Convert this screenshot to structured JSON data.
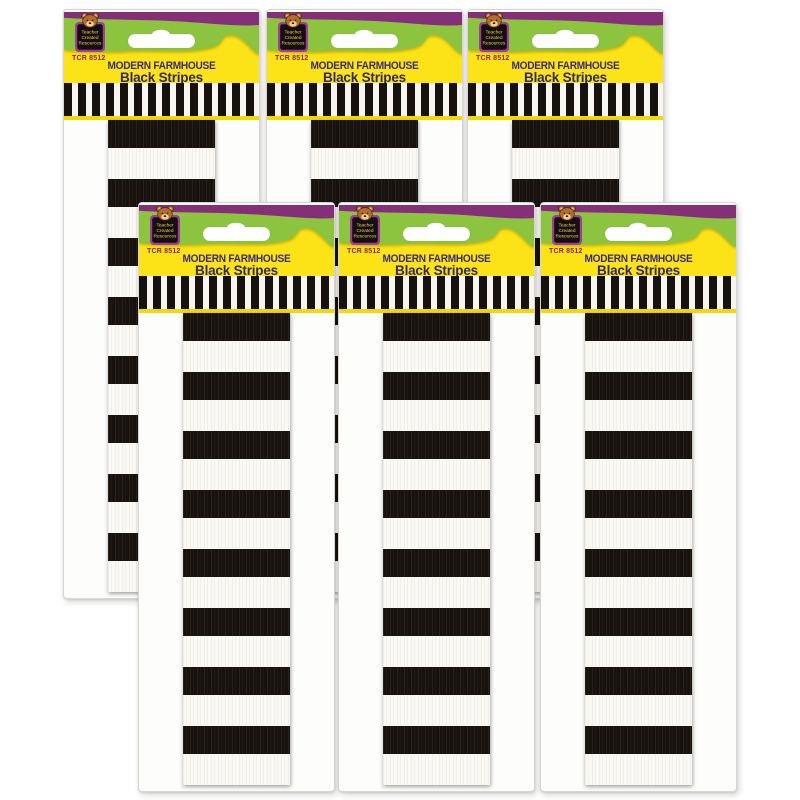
{
  "image_kind": "product-photo",
  "product": {
    "sku": "TCR 8512",
    "title_line1": "MODERN FARMHOUSE",
    "title_line2": "Black Stripes",
    "brand_badge": {
      "line1": "Teacher",
      "line2": "Created",
      "line3": "Resources"
    }
  },
  "colors": {
    "background": "#ffffff",
    "purple_band": "#842f78",
    "green_header": "#8cc33f",
    "yellow_banner": "#fbe318",
    "title_text": "#3a2b80",
    "sku_text": "#8c2441",
    "badge_frame": "#a23f92",
    "badge_fill": "#140f14",
    "badge_text": "#f0cf4a",
    "bear_fur": "#b26d2e",
    "stripe_black": "#18120e",
    "stripe_white": "#faf9f5"
  },
  "packages": [
    {
      "id": "back-left",
      "left": 63,
      "top": 9,
      "row": "back"
    },
    {
      "id": "back-middle",
      "left": 266,
      "top": 9,
      "row": "back"
    },
    {
      "id": "back-right",
      "left": 467,
      "top": 9,
      "row": "back"
    },
    {
      "id": "front-left",
      "left": 138,
      "top": 202,
      "row": "front"
    },
    {
      "id": "front-middle",
      "left": 338,
      "top": 202,
      "row": "front"
    },
    {
      "id": "front-right",
      "left": 540,
      "top": 202,
      "row": "front"
    }
  ]
}
